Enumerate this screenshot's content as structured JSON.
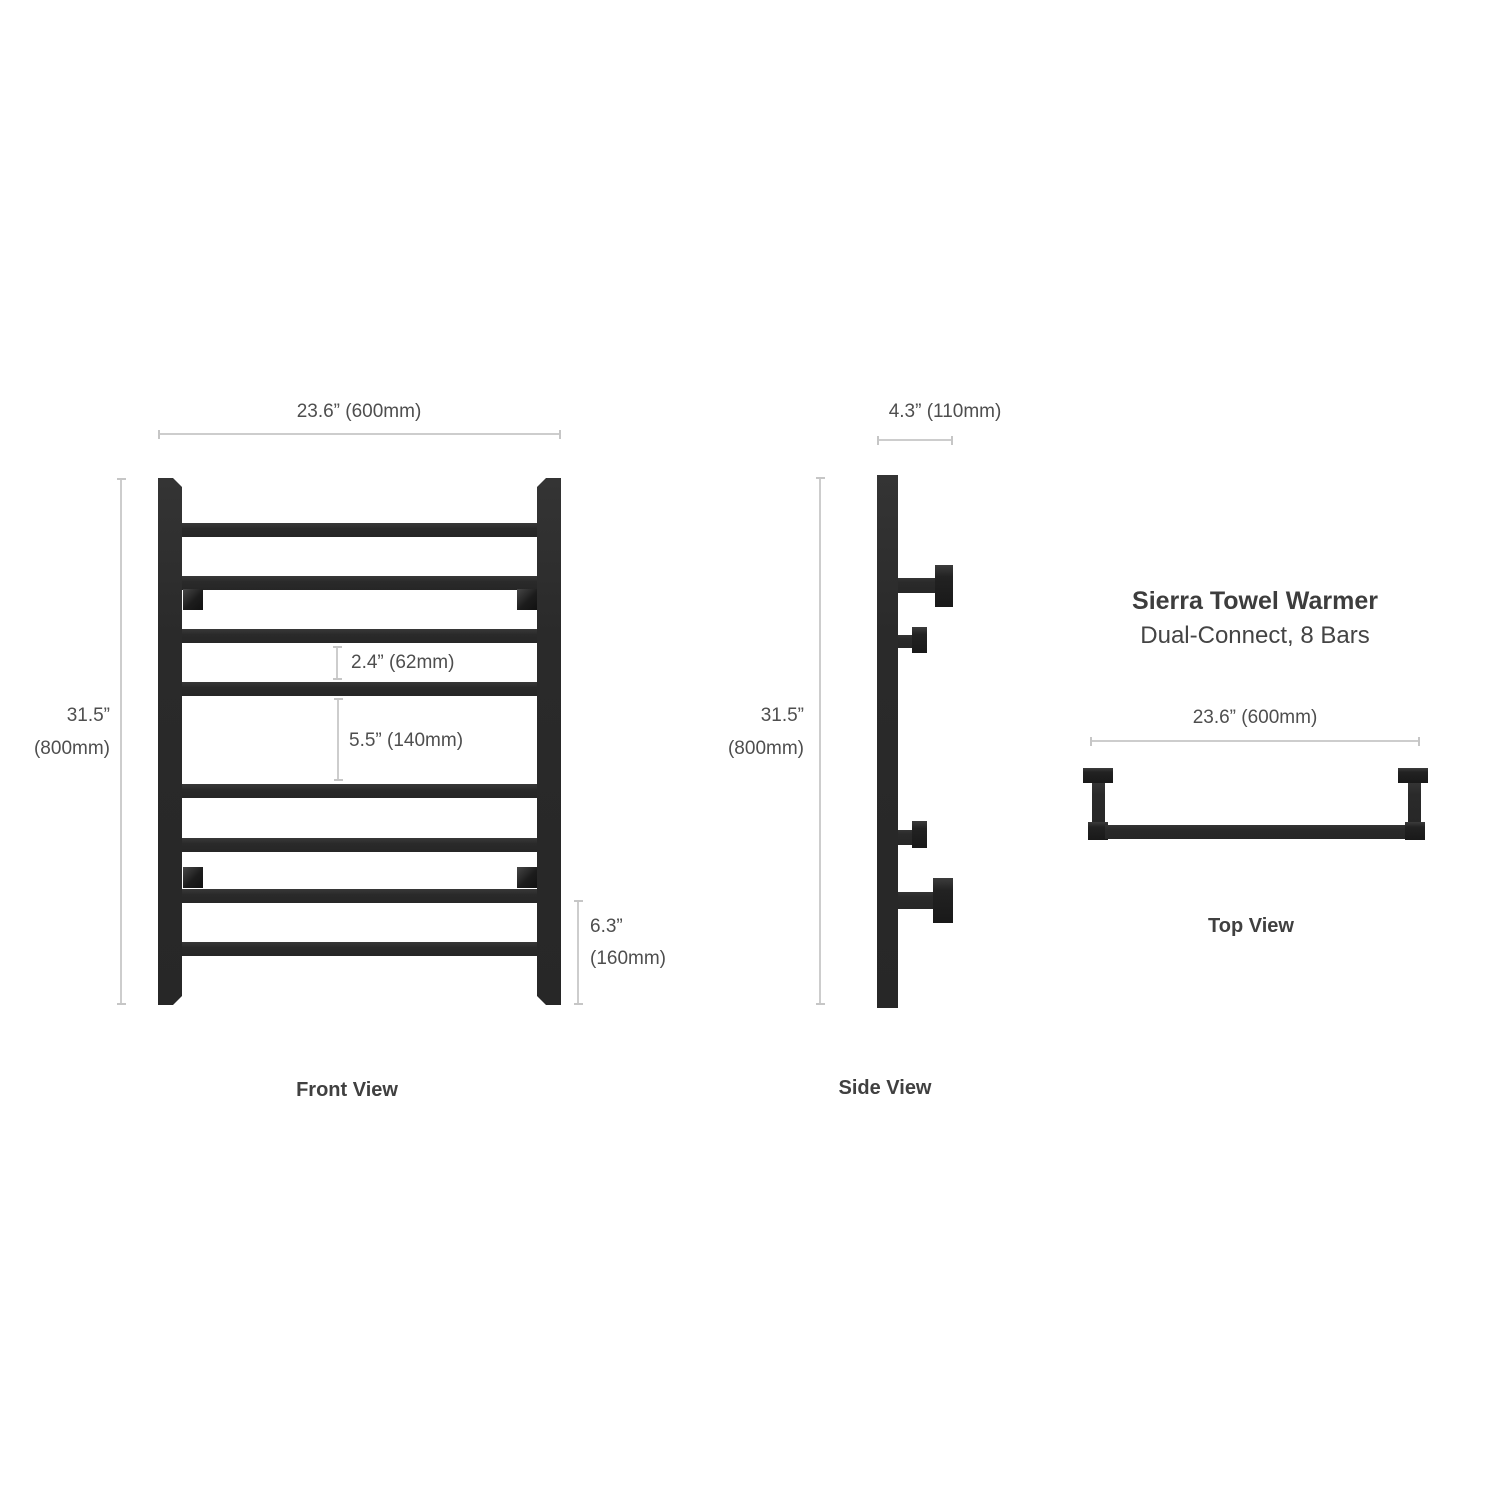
{
  "product": {
    "title": "Sierra Towel Warmer",
    "subtitle": "Dual-Connect, 8 Bars",
    "bar_count": 8,
    "colors": {
      "steel": "#2b2b2b",
      "steel_dark": "#1e1e1e",
      "dimension_line": "#cdcdcd",
      "dimension_text": "#4e4e4e",
      "label_text": "#404040",
      "background": "#ffffff"
    }
  },
  "front_view": {
    "label": "Front View",
    "width_dim": "23.6” (600mm)",
    "height_dim_in": "31.5”",
    "height_dim_mm": "(800mm)",
    "bar_gap_dim": "2.4” (62mm)",
    "section_gap_dim": "5.5” (140mm)",
    "bottom_dim_in": "6.3”",
    "bottom_dim_mm": "(160mm)"
  },
  "side_view": {
    "label": "Side View",
    "depth_dim": "4.3” (110mm)",
    "height_dim_in": "31.5”",
    "height_dim_mm": "(800mm)"
  },
  "top_view": {
    "label": "Top View",
    "width_dim": "23.6” (600mm)"
  }
}
